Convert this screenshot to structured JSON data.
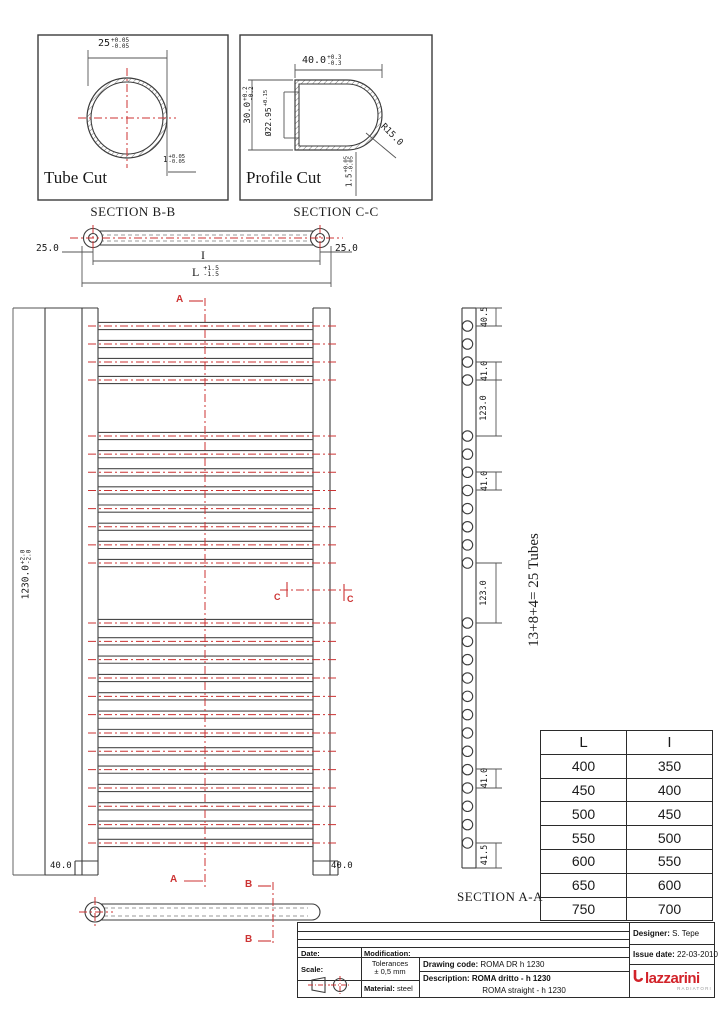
{
  "drawing": {
    "tube_cut": {
      "title": "Tube Cut",
      "caption": "SECTION B-B",
      "diameter": "25",
      "diameter_tol_plus": "+0.05",
      "diameter_tol_minus": "-0.05",
      "wall": "1",
      "wall_tol_plus": "+0.05",
      "wall_tol_minus": "-0.05"
    },
    "profile_cut": {
      "title": "Profile Cut",
      "caption": "SECTION C-C",
      "width": "40.0",
      "width_tol_plus": "+0.3",
      "width_tol_minus": "-0.3",
      "height": "30.0",
      "height_tol_plus": "+0.2",
      "height_tol_minus": "-0.2",
      "inner_diameter": "Ø22.95",
      "inner_diameter_tol": "+0.15",
      "corner_radius": "R15.0",
      "wall": "1.5",
      "wall_tol_plus": "+0.05",
      "wall_tol_minus": "-0.05"
    },
    "top_view": {
      "end_offset_left": "25.0",
      "end_offset_right": "25.0",
      "inner_length_label": "I",
      "overall_length_label": "L",
      "length_tol_plus": "+1.5",
      "length_tol_minus": "-1.5"
    },
    "front_view": {
      "overall_height": "1230.0",
      "height_tol_plus": "+2.0",
      "height_tol_minus": "-2.0",
      "rail_width_left": "40.0",
      "rail_width_right": "40.0",
      "section_a": "A",
      "section_b": "B",
      "section_c": "C",
      "tube_groups": [
        4,
        8,
        13
      ]
    },
    "section_aa": {
      "caption": "SECTION A-A",
      "tube_note": "13+8+4= 25 Tubes",
      "dims": [
        "40.5",
        "41.0",
        "123.0",
        "41.0",
        "123.0",
        "41.0",
        "41.5"
      ]
    }
  },
  "size_table": {
    "headers": [
      "L",
      "I"
    ],
    "rows": [
      [
        "400",
        "350"
      ],
      [
        "450",
        "400"
      ],
      [
        "500",
        "450"
      ],
      [
        "550",
        "500"
      ],
      [
        "600",
        "550"
      ],
      [
        "650",
        "600"
      ],
      [
        "750",
        "700"
      ]
    ]
  },
  "title_block": {
    "date_label": "Date:",
    "modification_label": "Modification:",
    "scale_label": "Scale:",
    "tolerances_label": "Tolerances",
    "tolerances_value": "± 0,5 mm",
    "material_label": "Material:",
    "material_value": "steel",
    "drawing_code_label": "Drawing code:",
    "drawing_code": "ROMA DR h 1230",
    "description_label": "Description:",
    "description": "ROMA dritto - h 1230",
    "description_en": "ROMA straight - h 1230",
    "designer_label": "Designer:",
    "designer": "S. Tepe",
    "issue_label": "Issue date:",
    "issue_date": "22-03-2010",
    "logo_text": "lazzarini",
    "logo_sub": "RADIATORI"
  },
  "colors": {
    "line": "#3c3c3c",
    "red": "#cc3333",
    "logo_red": "#d2232a",
    "logo_gray": "#9a9a9a"
  }
}
